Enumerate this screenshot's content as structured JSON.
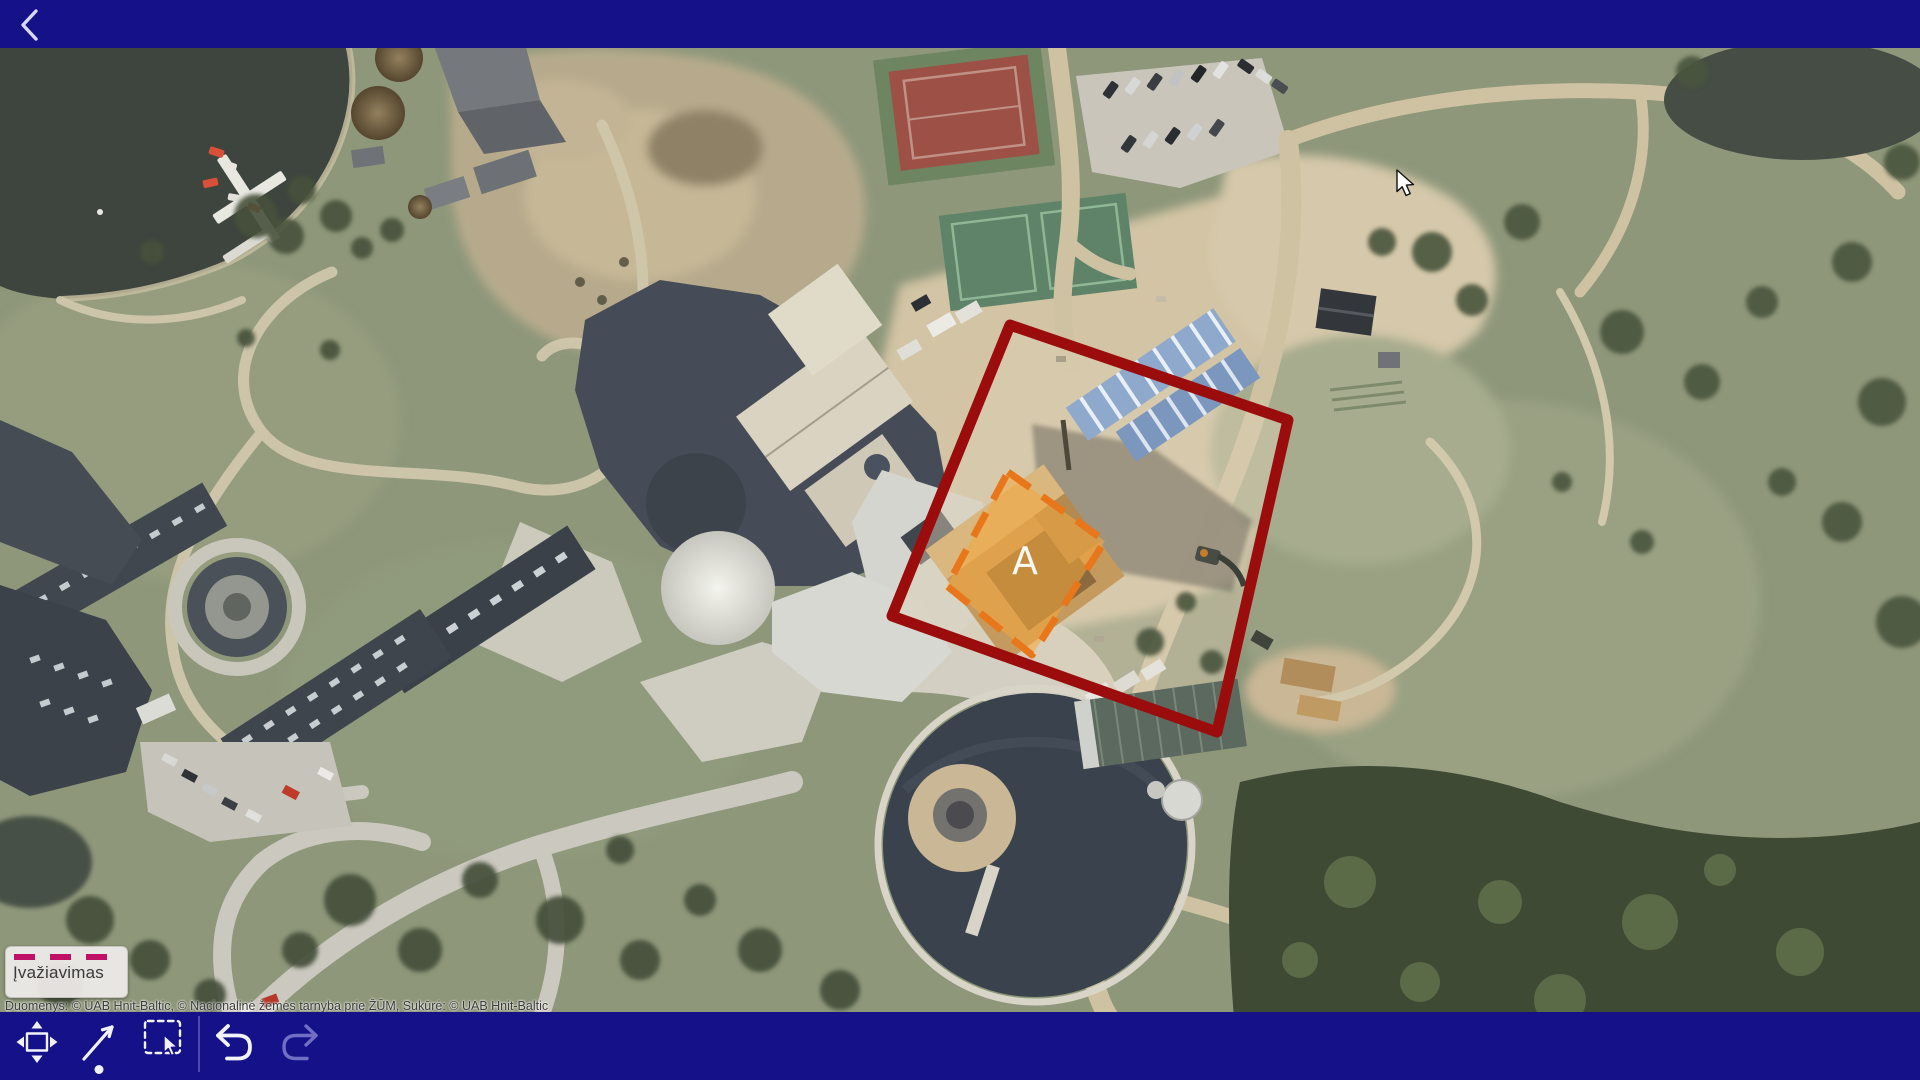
{
  "colors": {
    "bar": "#151289",
    "divider": "#4c48b0",
    "icon": "#f2f2fb",
    "icon2": "#716fc4",
    "red": "#9b0d0d",
    "orange": "#e8761a",
    "orangeFill": "rgba(246,167,61,0.55)",
    "dash": "#c00f66"
  },
  "top_bar": {
    "back_icon": "chevron-left"
  },
  "map": {
    "zone_label": "A",
    "callout": {
      "text": "Įvažiavimas",
      "swatch": "magenta-dashed-line"
    },
    "attribution": "Duomenys: © UAB Hnit-Baltic, © Nacionalinė žemės tarnyba prie ŽŪM, Sukūrė: © UAB Hnit-Baltic"
  },
  "toolbar": {
    "tools": [
      {
        "id": "pan",
        "icon": "pan-move-icon",
        "enabled": true
      },
      {
        "id": "draw-line",
        "icon": "diagonal-arrow-icon",
        "enabled": true
      },
      {
        "id": "marquee-select",
        "icon": "marquee-select-icon",
        "enabled": true
      },
      {
        "id": "undo",
        "icon": "undo-arrow-icon",
        "enabled": true
      },
      {
        "id": "redo",
        "icon": "redo-arrow-icon",
        "enabled": false
      }
    ]
  }
}
